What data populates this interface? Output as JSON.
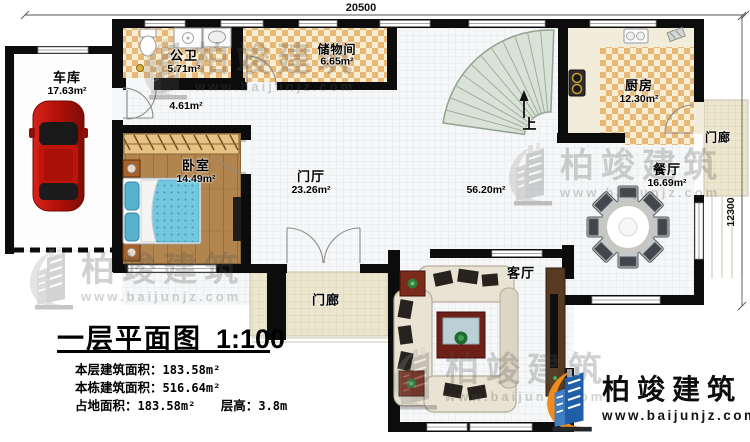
{
  "plan": {
    "dimension_top": "20500",
    "dimension_right": "12300",
    "stairs_up_label": "上"
  },
  "rooms": {
    "garage": {
      "name": "车库",
      "area": "17.63m²"
    },
    "bathroom": {
      "name": "公卫",
      "area": "5.71m²"
    },
    "storage": {
      "name": "储物间",
      "area": "6.65m²"
    },
    "hallway": {
      "area": "4.61m²"
    },
    "bedroom": {
      "name": "卧室",
      "area": "14.49m²"
    },
    "foyer": {
      "name": "门厅",
      "area": "23.26m²"
    },
    "kitchen": {
      "name": "厨房",
      "area": "12.30m²"
    },
    "dining": {
      "name": "餐厅",
      "area": "16.69m²"
    },
    "living": {
      "name": "客厅"
    },
    "open_space": {
      "area": "56.20m²"
    },
    "porch_right": {
      "name": "门廊"
    },
    "porch_bottom": {
      "name": "门廊"
    }
  },
  "title_block": {
    "title": "一层平面图",
    "scale": "1:100",
    "line1_label": "本层建筑面积：",
    "line1_value": "183.58m²",
    "line2_label": "本栋建筑面积：",
    "line2_value": "516.64m²",
    "line3a_label": "占地面积：",
    "line3a_value": "183.58m²",
    "line3b_label": "层高：",
    "line3b_value": "3.8m"
  },
  "branding": {
    "company": "柏竣建筑",
    "website": "www.baijunjz.com"
  }
}
